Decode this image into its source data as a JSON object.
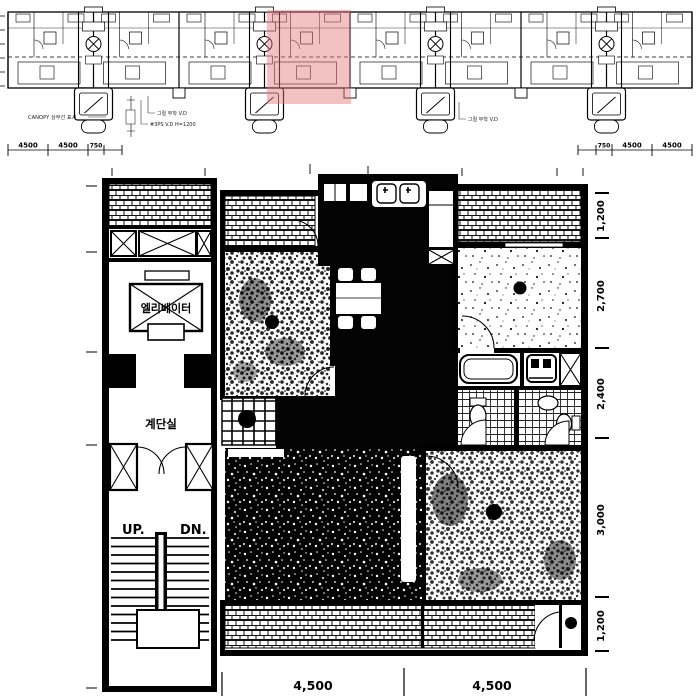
{
  "strip": {
    "highlight_color": "rgba(229,118,118,0.45)",
    "dims_left": [
      "4500",
      "4500",
      "750"
    ],
    "dims_right": [
      "750",
      "4500",
      "4500"
    ],
    "annotations": {
      "canopy": "CANOPY 상부선 표시",
      "vd_line1": "그릴 부착 V.D",
      "vd_line2": "#3PS V.D H=1200",
      "vd_right": "그릴 부착 V.D"
    }
  },
  "plan": {
    "labels": {
      "elevator": "엘리베이터",
      "staircase": "계단실",
      "up": "UP.",
      "down": "DN."
    },
    "dims_bottom": [
      "4,500",
      "4,500"
    ],
    "dims_right": [
      "1,200",
      "2,700",
      "2,400",
      "3,000",
      "1,200"
    ]
  },
  "ink": "#000000",
  "paper": "#ffffff"
}
